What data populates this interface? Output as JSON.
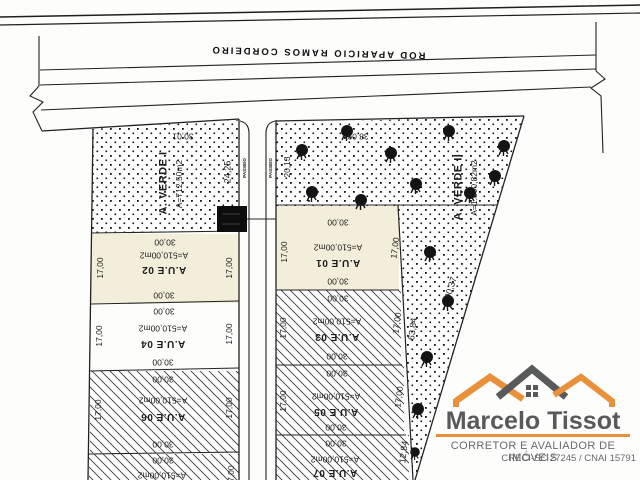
{
  "road": {
    "label": "ROD APARICIO RAMOS CORDEIRO"
  },
  "green_area_1": {
    "name": "A. VERDE I",
    "area": "A=712,50m2",
    "dim_top": "30,01",
    "dim_right": "24,25"
  },
  "green_area_2": {
    "name": "A. VERDE II",
    "area": "A=1.800,82m2",
    "dim_top": "38,09",
    "dim_left": "20,13",
    "dim_diagonal": "90,37",
    "dim_edge_upper": "63,84",
    "dim_edge_lower": "12,84"
  },
  "street": {
    "sidewalk_left": "PASSEIO",
    "sidewalk_right": "PASSEIO"
  },
  "lots_left": [
    {
      "name": "A.U.E 02",
      "area": "A=510,00m2",
      "dim_top": "30,00",
      "dim_bottom": "30,00",
      "dim_left": "17,00",
      "dim_right": "17,00"
    },
    {
      "name": "A.U.E 04",
      "area": "A=510,00m2",
      "dim_top": "30,00",
      "dim_bottom": "30,00",
      "dim_left": "17,00",
      "dim_right": "17,00"
    },
    {
      "name": "A.U.E 06",
      "area": "A=510,00m2",
      "dim_top": "30,00",
      "dim_bottom": "30,00",
      "dim_left": "17,00",
      "dim_right": "17,00"
    },
    {
      "area": "A=510,00m2",
      "dim_top": "30,00",
      "dim_right": "17,00"
    }
  ],
  "lots_right": [
    {
      "name": "A.U.E 01",
      "area": "A=510,00m2",
      "dim_top": "30,00",
      "dim_bottom": "30,00",
      "dim_left": "17,00",
      "dim_right": "17,00"
    },
    {
      "name": "A.U.E 03",
      "area": "A=510,00m2",
      "dim_top": "30,00",
      "dim_bottom": "30,00",
      "dim_left": "17,00",
      "dim_right": "17,00"
    },
    {
      "name": "A.U.E 05",
      "area": "A=510,00m2",
      "dim_top": "30,00",
      "dim_bottom": "30,00",
      "dim_left": "17,00",
      "dim_right": "17,00"
    },
    {
      "name": "A.U.E 07",
      "area": "A=510,00m2",
      "dim_top": "30,00"
    }
  ],
  "logo": {
    "title": "Marcelo Tissot",
    "subtitle": "CORRETOR E AVALIADOR DE IMÓVEIS",
    "registry": "CRECI-SC 27245 / CNAI 15791",
    "colors": {
      "orange": "#e8913a",
      "gray": "#58595b"
    }
  }
}
